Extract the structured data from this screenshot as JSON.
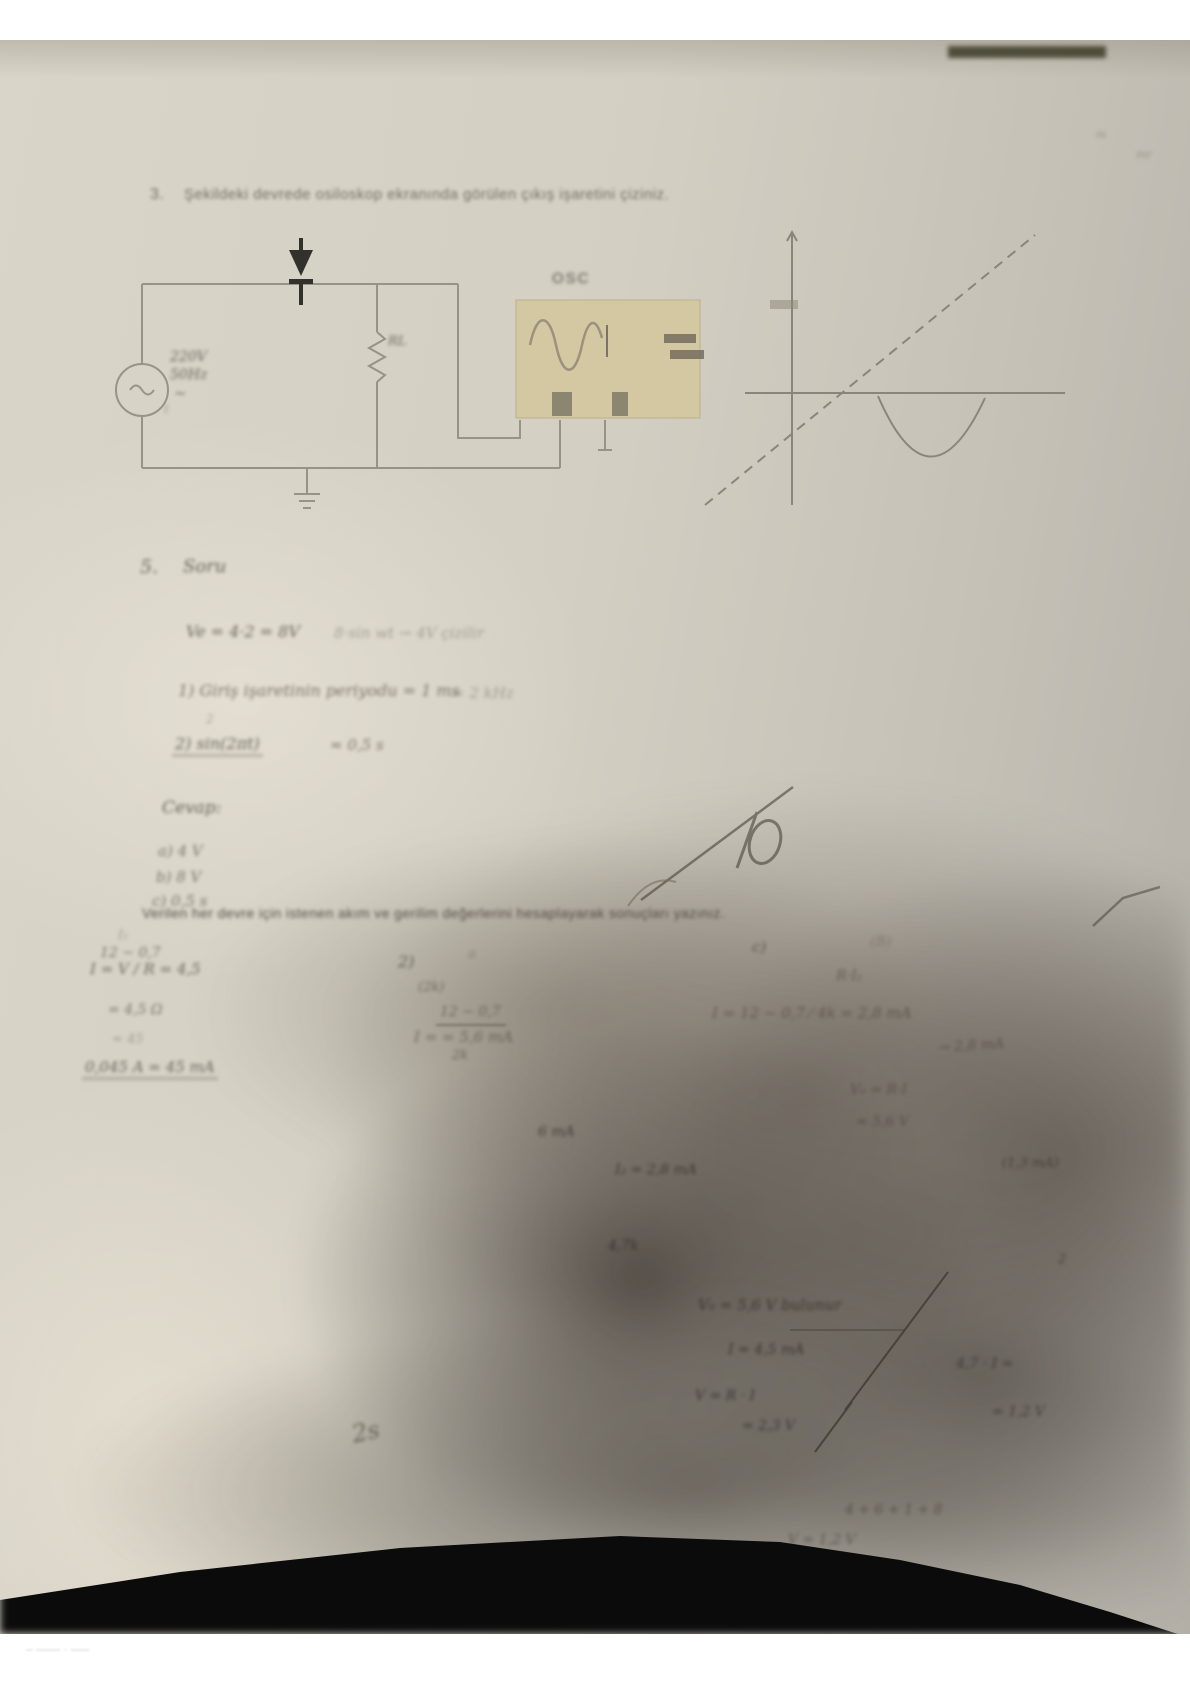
{
  "photo": {
    "paper_color": "#d3cfc3",
    "table_color": "#0b0b0c",
    "scope_screen_color": "#d5c8a0"
  },
  "question3": {
    "number": "3.",
    "text": "Şekildeki devrede osiloskop ekranında görülen çıkış işaretini çiziniz."
  },
  "circuit": {
    "source_label_line1": "220V",
    "source_label_line2": "50Hz",
    "source_tilde": "~",
    "source_small_mark": "t",
    "resistor_label": "RL",
    "scope_label": "OSC"
  },
  "section5": {
    "number": "5.",
    "title": "Soru",
    "line1_left": "Ve = 4·2 = 8V",
    "line1_right": "8·sin wt → 4V çizilir",
    "line2": "1) Giriş işaretinin periyodu = 1 ms",
    "line2_right": "= 2 kHz",
    "line3_sup": "2",
    "line3_main": "2)  sin(2πt)",
    "line3_right": "≈  0,5 s",
    "answers_title": "Cevap:",
    "answer_a": "a)  4 V",
    "answer_b": "b)  8 V",
    "answer_c": "c)  0,5 s"
  },
  "grade": {
    "value": "10"
  },
  "question_bottom": {
    "text": "Verilen her devre için istenen akım ve gerilim değerlerini hesaplayarak sonuçları yazınız."
  },
  "work_left": {
    "lines": [
      "I₁",
      "12 − 0,7",
      "I = V / R = 4,5",
      "= 4,5 Ω",
      "≈ 45",
      "0,045 A = 45 mA"
    ]
  },
  "work_mid": {
    "lines": [
      "2)",
      "a",
      "(2k)",
      "12 − 0,7",
      "I =              = 5,6 mA",
      "2k"
    ]
  },
  "work_right": {
    "lines": [
      "c)",
      "(B)",
      "R·I₂",
      "I = 12 − 0,7 ⁄ 4k = 2,8 mA",
      "→ 2,8 mA",
      "V₀ = R·I",
      "= 5,6 V"
    ]
  },
  "shadow_notes": {
    "lines": [
      "6 mA",
      "I₂ = 2,8 mA",
      "4,7k",
      "V₀ = 5,6 V bulunur",
      "I = 4,5 mA",
      "V = R · I",
      "= 2,3 V"
    ]
  },
  "right_notes": {
    "lines": [
      "(1,3 mA)",
      "2",
      "4,7 · I =",
      "= 1,2 V",
      "4 + 6 + 1 + 8",
      "V = 1,2 V"
    ]
  },
  "marks": {
    "curl": "2s",
    "corner1": "m",
    "corner2": "mr",
    "bottom_strip": "–  ——   · —–"
  }
}
